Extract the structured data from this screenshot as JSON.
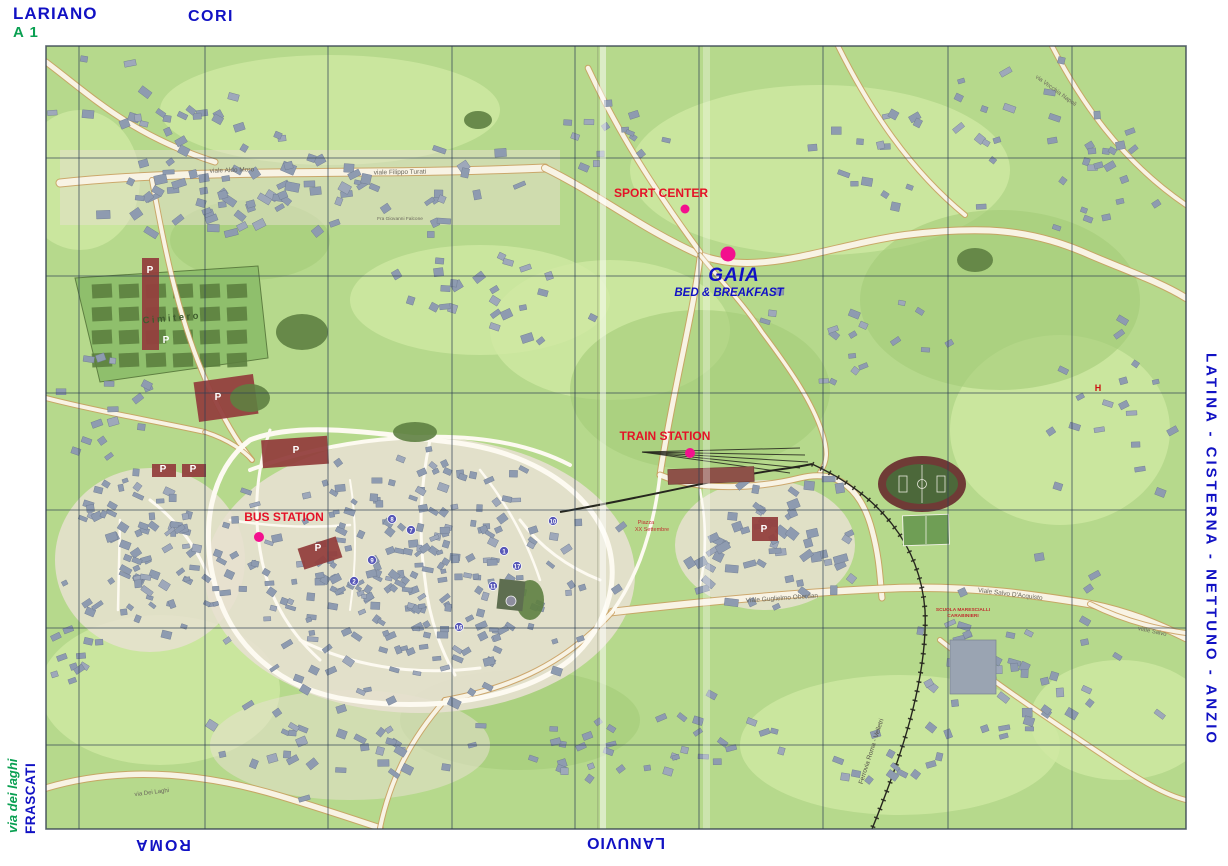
{
  "edge_labels": {
    "top_left_city": "LARIANO",
    "top_left_road": "A 1",
    "top_city": "CORI",
    "right_cities": "LATINA - CISTERNA - NETTUNO - ANZIO",
    "left_road": "via dei laghi",
    "left_city": "FRASCATI",
    "bottom_left_city": "ROMA",
    "bottom_city": "LANUVIO"
  },
  "pois": [
    {
      "id": "sport-center",
      "label": "SPORT CENTER",
      "x": 685,
      "y": 209,
      "r": 4.5,
      "label_x": 661,
      "label_y": 197,
      "label_size": 12
    },
    {
      "id": "gaia-bed-breakfast",
      "label": "GAIA",
      "sublabel": "BED & BREAKFAST",
      "x": 728,
      "y": 254,
      "r": 7.5,
      "label_x": 734,
      "label_y": 281,
      "label_size": 19,
      "sublabel_x": 729,
      "sublabel_y": 296,
      "sublabel_size": 11.5
    },
    {
      "id": "train-station",
      "label": "TRAIN STATION",
      "x": 690,
      "y": 453,
      "r": 5,
      "label_x": 665,
      "label_y": 440,
      "label_size": 12
    },
    {
      "id": "bus-station",
      "label": "BUS STATION",
      "x": 259,
      "y": 537,
      "r": 5,
      "label_x": 284,
      "label_y": 521,
      "label_size": 12
    }
  ],
  "street_labels": [
    {
      "text": "viale Aldo Moro",
      "x": 232,
      "y": 172,
      "rot": -2,
      "size": 6.5,
      "color": "#6a675c",
      "bold": false
    },
    {
      "text": "viale  Filippo  Turati",
      "x": 400,
      "y": 174,
      "rot": -1,
      "size": 6.5,
      "color": "#6a675c",
      "bold": false
    },
    {
      "text": "Fra Giovanni Falcone",
      "x": 400,
      "y": 220,
      "rot": 0,
      "size": 4.8,
      "color": "#6a675c",
      "bold": false
    },
    {
      "text": "Cimitero",
      "x": 172,
      "y": 321,
      "rot": -5,
      "size": 9.5,
      "color": "#3f5c2e",
      "bold": true,
      "spacing": 2.5
    },
    {
      "text": "Viale  Guglielmo  Oberdan",
      "x": 782,
      "y": 600,
      "rot": -4,
      "size": 6.5,
      "color": "#6a675c",
      "bold": false
    },
    {
      "text": "Viale  Salvo  D'Acquisto",
      "x": 1010,
      "y": 596,
      "rot": 7,
      "size": 6.5,
      "color": "#6a675c",
      "bold": false
    },
    {
      "text": "viale Salvo",
      "x": 1152,
      "y": 633,
      "rot": 12,
      "size": 6,
      "color": "#6a675c",
      "bold": false
    },
    {
      "text": "via  Dei  Laghi",
      "x": 152,
      "y": 794,
      "rot": -7,
      "size": 6,
      "color": "#6a675c",
      "bold": false
    },
    {
      "text": "Ferrovia  Roma - Velletri",
      "x": 873,
      "y": 752,
      "rot": -72,
      "size": 6.5,
      "color": "#55534a",
      "bold": false
    },
    {
      "text": "via  Vecchia  Napoli",
      "x": 1055,
      "y": 92,
      "rot": 36,
      "size": 6,
      "color": "#6a675c",
      "bold": false
    },
    {
      "text": "SCUOLA MARESCIALLI",
      "x": 963,
      "y": 611,
      "rot": 0,
      "size": 4.8,
      "color": "#c03030",
      "bold": true
    },
    {
      "text": "CARABINIERI",
      "x": 963,
      "y": 617,
      "rot": 0,
      "size": 4.8,
      "color": "#c03030",
      "bold": true
    },
    {
      "text": "Piazza",
      "x": 646,
      "y": 524,
      "rot": 0,
      "size": 5.5,
      "color": "#c03030",
      "bold": false
    },
    {
      "text": "XX Settembre",
      "x": 652,
      "y": 531,
      "rot": 0,
      "size": 5.5,
      "color": "#c03030",
      "bold": false
    },
    {
      "text": "H",
      "x": 1098,
      "y": 391,
      "rot": 0,
      "size": 9,
      "color": "#cc1111",
      "bold": true
    }
  ],
  "parking_labels": [
    {
      "letter": "P",
      "x": 150,
      "y": 273
    },
    {
      "letter": "P",
      "x": 166,
      "y": 343
    },
    {
      "letter": "P",
      "x": 218,
      "y": 400
    },
    {
      "letter": "P",
      "x": 296,
      "y": 453
    },
    {
      "letter": "P",
      "x": 163,
      "y": 472
    },
    {
      "letter": "P",
      "x": 193,
      "y": 472
    },
    {
      "letter": "P",
      "x": 764,
      "y": 532
    },
    {
      "letter": "P",
      "x": 318,
      "y": 551
    }
  ],
  "town_markers": [
    {
      "n": "1",
      "x": 504,
      "y": 551
    },
    {
      "n": "2",
      "x": 354,
      "y": 581
    },
    {
      "n": "7",
      "x": 411,
      "y": 530
    },
    {
      "n": "8",
      "x": 392,
      "y": 519
    },
    {
      "n": "9",
      "x": 372,
      "y": 560
    },
    {
      "n": "10",
      "x": 553,
      "y": 521
    },
    {
      "n": "11",
      "x": 493,
      "y": 586
    },
    {
      "n": "16",
      "x": 459,
      "y": 627
    },
    {
      "n": "17",
      "x": 517,
      "y": 566
    }
  ],
  "colors": {
    "land": "#b6d98c",
    "land_light": "#cfe8a2",
    "land_dark": "#a4cc78",
    "road_fill": "#f8f3e4",
    "road_casing": "#c99d5e",
    "building": "#8e9bb0",
    "building_stroke": "#6e7a90",
    "urban_base": "#e7e0d0",
    "grid": "#2f4054",
    "poi_dot": "#f3108e",
    "poi_text_red": "#e41227",
    "blue_text": "#1111c4",
    "green_text": "#0aa052",
    "parking": "#93403e",
    "cemetery": "#8fbf6c",
    "cemetery_plot": "#5c7f3f",
    "stadium_ring": "#6f3b36",
    "stadium_field": "#4c683a",
    "railway": "#26261e"
  }
}
